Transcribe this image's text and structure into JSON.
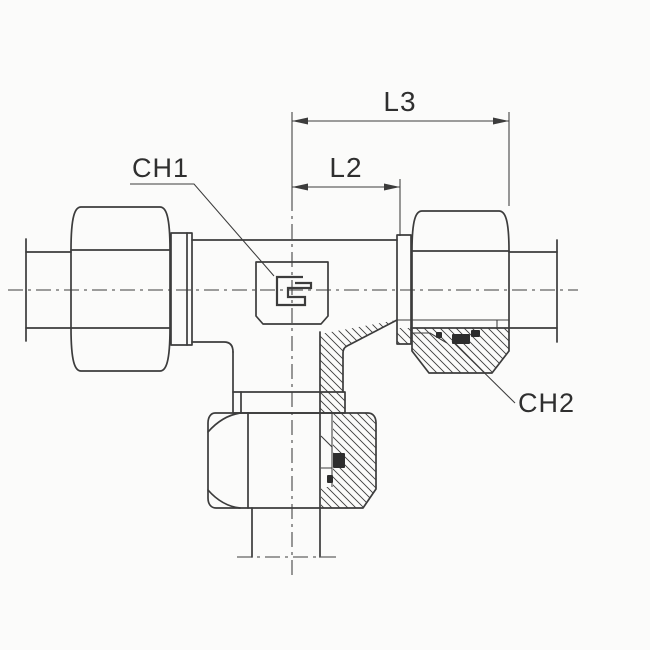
{
  "drawing": {
    "labels": {
      "l3": "L3",
      "l2": "L2",
      "ch1": "CH1",
      "ch2": "CH2"
    },
    "colors": {
      "line": "#3c3c3c",
      "background": "#fbfbfa",
      "seal": "#2d2d2d",
      "text": "#2f2f2f"
    }
  }
}
